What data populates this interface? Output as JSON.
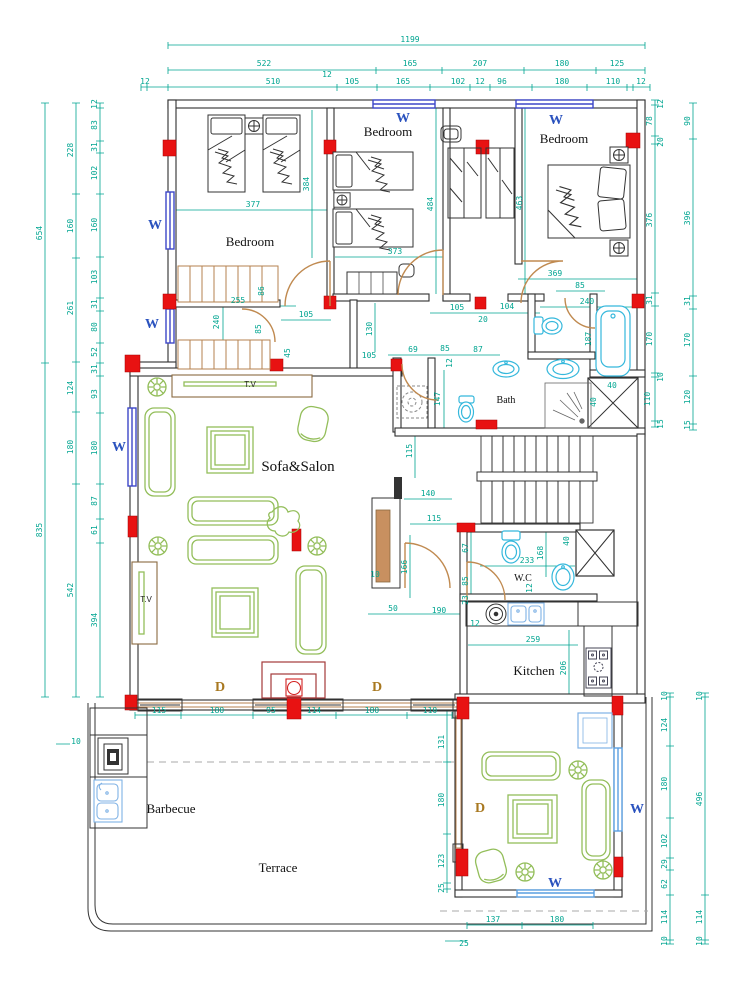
{
  "colors": {
    "dimension": "#00A591",
    "wall": "#2f2f2f",
    "window_blue": "#3D46C8",
    "window_light": "#5A9FE0",
    "fixture_cyan": "#35B8DC",
    "furniture_green": "#93BE5A",
    "door_brown": "#C08A50",
    "column_red": "#E81212",
    "label_blue": "#2A52BE",
    "label_brown": "#A87820",
    "fireplace": "#A33A3A"
  },
  "labels": [
    {
      "t": "1199",
      "x": 410,
      "y": 42
    },
    {
      "t": "522",
      "x": 264,
      "y": 66
    },
    {
      "t": "165",
      "x": 410,
      "y": 66
    },
    {
      "t": "207",
      "x": 480,
      "y": 66
    },
    {
      "t": "180",
      "x": 562,
      "y": 66
    },
    {
      "t": "125",
      "x": 617,
      "y": 66
    },
    {
      "t": "12",
      "x": 145,
      "y": 84
    },
    {
      "t": "510",
      "x": 273,
      "y": 84
    },
    {
      "t": "12",
      "x": 327,
      "y": 77
    },
    {
      "t": "105",
      "x": 352,
      "y": 84
    },
    {
      "t": "165",
      "x": 403,
      "y": 84
    },
    {
      "t": "102",
      "x": 458,
      "y": 84
    },
    {
      "t": "12",
      "x": 480,
      "y": 84
    },
    {
      "t": "96",
      "x": 502,
      "y": 84
    },
    {
      "t": "180",
      "x": 562,
      "y": 84
    },
    {
      "t": "110",
      "x": 613,
      "y": 84
    },
    {
      "t": "12",
      "x": 641,
      "y": 84
    },
    {
      "t": "654",
      "x": 42,
      "y": 233,
      "r": -90
    },
    {
      "t": "835",
      "x": 42,
      "y": 530,
      "r": -90
    },
    {
      "t": "228",
      "x": 73,
      "y": 150,
      "r": -90
    },
    {
      "t": "160",
      "x": 73,
      "y": 226,
      "r": -90
    },
    {
      "t": "261",
      "x": 73,
      "y": 308,
      "r": -90
    },
    {
      "t": "124",
      "x": 73,
      "y": 388,
      "r": -90
    },
    {
      "t": "180",
      "x": 73,
      "y": 447,
      "r": -90
    },
    {
      "t": "542",
      "x": 73,
      "y": 590,
      "r": -90
    },
    {
      "t": "12",
      "x": 97,
      "y": 104,
      "r": -90
    },
    {
      "t": "83",
      "x": 97,
      "y": 125,
      "r": -90
    },
    {
      "t": "31",
      "x": 97,
      "y": 147,
      "r": -90
    },
    {
      "t": "102",
      "x": 97,
      "y": 173,
      "r": -90
    },
    {
      "t": "160",
      "x": 97,
      "y": 225,
      "r": -90
    },
    {
      "t": "103",
      "x": 97,
      "y": 277,
      "r": -90
    },
    {
      "t": "31",
      "x": 97,
      "y": 304,
      "r": -90
    },
    {
      "t": "80",
      "x": 97,
      "y": 327,
      "r": -90
    },
    {
      "t": "52",
      "x": 97,
      "y": 352,
      "r": -90
    },
    {
      "t": "31",
      "x": 97,
      "y": 369,
      "r": -90
    },
    {
      "t": "93",
      "x": 97,
      "y": 394,
      "r": -90
    },
    {
      "t": "180",
      "x": 97,
      "y": 448,
      "r": -90
    },
    {
      "t": "87",
      "x": 97,
      "y": 501,
      "r": -90
    },
    {
      "t": "61",
      "x": 97,
      "y": 530,
      "r": -90
    },
    {
      "t": "394",
      "x": 97,
      "y": 620,
      "r": -90
    },
    {
      "t": "12",
      "x": 663,
      "y": 104,
      "r": -90
    },
    {
      "t": "78",
      "x": 652,
      "y": 121,
      "r": -90
    },
    {
      "t": "20",
      "x": 663,
      "y": 142,
      "r": -90
    },
    {
      "t": "376",
      "x": 652,
      "y": 220,
      "r": -90
    },
    {
      "t": "31",
      "x": 652,
      "y": 300,
      "r": -90
    },
    {
      "t": "170",
      "x": 652,
      "y": 339,
      "r": -90
    },
    {
      "t": "10",
      "x": 663,
      "y": 377,
      "r": -90
    },
    {
      "t": "110",
      "x": 650,
      "y": 399,
      "r": -90
    },
    {
      "t": "15",
      "x": 663,
      "y": 424,
      "r": -90
    },
    {
      "t": "90",
      "x": 690,
      "y": 121,
      "r": -90
    },
    {
      "t": "396",
      "x": 690,
      "y": 218,
      "r": -90
    },
    {
      "t": "31",
      "x": 690,
      "y": 301,
      "r": -90
    },
    {
      "t": "170",
      "x": 690,
      "y": 340,
      "r": -90
    },
    {
      "t": "120",
      "x": 690,
      "y": 397,
      "r": -90
    },
    {
      "t": "15",
      "x": 690,
      "y": 425,
      "r": -90
    },
    {
      "t": "10",
      "x": 667,
      "y": 696,
      "r": -90
    },
    {
      "t": "124",
      "x": 667,
      "y": 725,
      "r": -90
    },
    {
      "t": "180",
      "x": 667,
      "y": 784,
      "r": -90
    },
    {
      "t": "102",
      "x": 667,
      "y": 841,
      "r": -90
    },
    {
      "t": "29",
      "x": 667,
      "y": 864,
      "r": -90
    },
    {
      "t": "62",
      "x": 667,
      "y": 884,
      "r": -90
    },
    {
      "t": "114",
      "x": 667,
      "y": 917,
      "r": -90
    },
    {
      "t": "10",
      "x": 667,
      "y": 941,
      "r": -90
    },
    {
      "t": "10",
      "x": 702,
      "y": 696,
      "r": -90
    },
    {
      "t": "496",
      "x": 702,
      "y": 799,
      "r": -90
    },
    {
      "t": "114",
      "x": 702,
      "y": 917,
      "r": -90
    },
    {
      "t": "10",
      "x": 702,
      "y": 941,
      "r": -90
    },
    {
      "t": "115",
      "x": 159,
      "y": 713
    },
    {
      "t": "180",
      "x": 217,
      "y": 713
    },
    {
      "t": "95",
      "x": 271,
      "y": 713
    },
    {
      "t": "114",
      "x": 314,
      "y": 713
    },
    {
      "t": "180",
      "x": 372,
      "y": 713
    },
    {
      "t": "110",
      "x": 430,
      "y": 713
    },
    {
      "t": "131",
      "x": 444,
      "y": 742,
      "r": -90
    },
    {
      "t": "180",
      "x": 444,
      "y": 800,
      "r": -90
    },
    {
      "t": "123",
      "x": 444,
      "y": 861,
      "r": -90
    },
    {
      "t": "25",
      "x": 444,
      "y": 888,
      "r": -90
    },
    {
      "t": "137",
      "x": 493,
      "y": 922
    },
    {
      "t": "180",
      "x": 557,
      "y": 922
    },
    {
      "t": "25",
      "x": 464,
      "y": 946
    },
    {
      "t": "10",
      "x": 76,
      "y": 744
    },
    {
      "t": "377",
      "x": 253,
      "y": 207
    },
    {
      "t": "384",
      "x": 309,
      "y": 184,
      "r": -90
    },
    {
      "t": "373",
      "x": 395,
      "y": 254
    },
    {
      "t": "484",
      "x": 433,
      "y": 204,
      "r": -90
    },
    {
      "t": "463",
      "x": 522,
      "y": 203,
      "r": -90
    },
    {
      "t": "369",
      "x": 555,
      "y": 276
    },
    {
      "t": "85",
      "x": 580,
      "y": 288
    },
    {
      "t": "240",
      "x": 587,
      "y": 304
    },
    {
      "t": "255",
      "x": 238,
      "y": 303
    },
    {
      "t": "86",
      "x": 264,
      "y": 291,
      "r": -90
    },
    {
      "t": "240",
      "x": 219,
      "y": 322,
      "r": -90
    },
    {
      "t": "85",
      "x": 261,
      "y": 329,
      "r": -90
    },
    {
      "t": "105",
      "x": 306,
      "y": 317
    },
    {
      "t": "45",
      "x": 290,
      "y": 353,
      "r": -90
    },
    {
      "t": "105",
      "x": 457,
      "y": 310
    },
    {
      "t": "104",
      "x": 507,
      "y": 309
    },
    {
      "t": "20",
      "x": 483,
      "y": 322
    },
    {
      "t": "130",
      "x": 372,
      "y": 329,
      "r": -90
    },
    {
      "t": "105",
      "x": 369,
      "y": 358
    },
    {
      "t": "69",
      "x": 413,
      "y": 352
    },
    {
      "t": "85",
      "x": 445,
      "y": 351
    },
    {
      "t": "87",
      "x": 478,
      "y": 352
    },
    {
      "t": "12",
      "x": 452,
      "y": 363,
      "r": -90
    },
    {
      "t": "187",
      "x": 591,
      "y": 339,
      "r": -90
    },
    {
      "t": "147",
      "x": 440,
      "y": 399,
      "r": -90
    },
    {
      "t": "40",
      "x": 612,
      "y": 388
    },
    {
      "t": "40",
      "x": 596,
      "y": 402,
      "r": -90
    },
    {
      "t": "115",
      "x": 412,
      "y": 451,
      "r": -90
    },
    {
      "t": "140",
      "x": 428,
      "y": 496
    },
    {
      "t": "115",
      "x": 434,
      "y": 521
    },
    {
      "t": "166",
      "x": 407,
      "y": 567,
      "r": -90
    },
    {
      "t": "10",
      "x": 375,
      "y": 577
    },
    {
      "t": "50",
      "x": 393,
      "y": 611
    },
    {
      "t": "190",
      "x": 439,
      "y": 613
    },
    {
      "t": "67",
      "x": 468,
      "y": 548,
      "r": -90
    },
    {
      "t": "85",
      "x": 468,
      "y": 581,
      "r": -90
    },
    {
      "t": "23",
      "x": 468,
      "y": 600,
      "r": -90
    },
    {
      "t": "12",
      "x": 475,
      "y": 626
    },
    {
      "t": "233",
      "x": 527,
      "y": 563
    },
    {
      "t": "168",
      "x": 543,
      "y": 553,
      "r": -90
    },
    {
      "t": "12",
      "x": 532,
      "y": 588,
      "r": -90
    },
    {
      "t": "40",
      "x": 569,
      "y": 541,
      "r": -90
    },
    {
      "t": "259",
      "x": 533,
      "y": 642
    },
    {
      "t": "206",
      "x": 566,
      "y": 668,
      "r": -90
    },
    {
      "t": "Bedroom",
      "x": 250,
      "y": 246,
      "c": "room"
    },
    {
      "t": "Bedroom",
      "x": 388,
      "y": 136,
      "c": "room"
    },
    {
      "t": "Bedroom",
      "x": 564,
      "y": 143,
      "c": "room"
    },
    {
      "t": "Sofa&Salon",
      "x": 298,
      "y": 471,
      "c": "room-lg"
    },
    {
      "t": "Bath",
      "x": 506,
      "y": 403,
      "c": "room-sm"
    },
    {
      "t": "W.C",
      "x": 523,
      "y": 581,
      "c": "room-sm"
    },
    {
      "t": "Kitchen",
      "x": 534,
      "y": 675,
      "c": "room"
    },
    {
      "t": "Barbecue",
      "x": 171,
      "y": 813,
      "c": "room"
    },
    {
      "t": "Terrace",
      "x": 278,
      "y": 872,
      "c": "room"
    },
    {
      "t": "W",
      "x": 403,
      "y": 122,
      "c": "w"
    },
    {
      "t": "W",
      "x": 556,
      "y": 124,
      "c": "w"
    },
    {
      "t": "W",
      "x": 155,
      "y": 229,
      "c": "w"
    },
    {
      "t": "W",
      "x": 152,
      "y": 328,
      "c": "w"
    },
    {
      "t": "W",
      "x": 119,
      "y": 451,
      "c": "w"
    },
    {
      "t": "W",
      "x": 637,
      "y": 813,
      "c": "w"
    },
    {
      "t": "W",
      "x": 555,
      "y": 887,
      "c": "w"
    },
    {
      "t": "D",
      "x": 220,
      "y": 691,
      "c": "d"
    },
    {
      "t": "D",
      "x": 377,
      "y": 691,
      "c": "d"
    },
    {
      "t": "D",
      "x": 480,
      "y": 812,
      "c": "d"
    },
    {
      "t": "T.V",
      "x": 250,
      "y": 387,
      "c": "tv"
    },
    {
      "t": "T.V",
      "x": 146,
      "y": 602,
      "c": "tv"
    }
  ]
}
